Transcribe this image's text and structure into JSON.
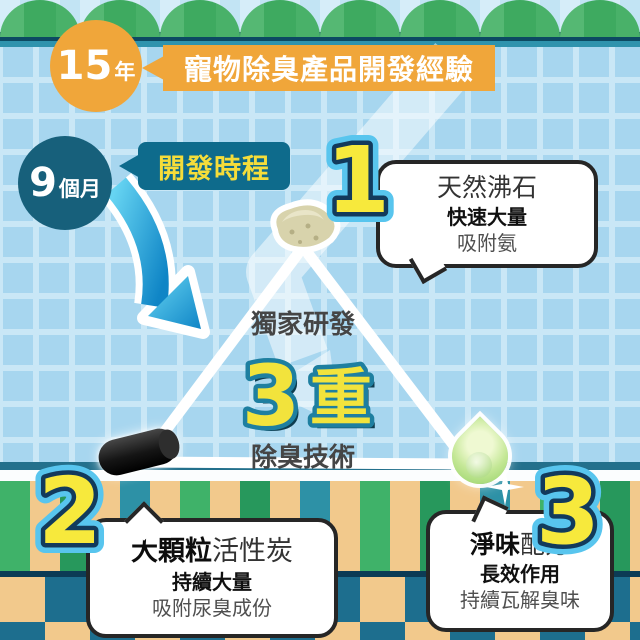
{
  "colors": {
    "background_tile": "#A7D6EF",
    "accent_orange": "#F0A63A",
    "accent_teal_dark": "#0E6B8C",
    "accent_yellow": "#F5E53E",
    "arrow_blue": "#29A8DC",
    "stripe_tan": "#F2C98C",
    "stripe_green": "#3FB269",
    "checker_teal": "#1D6E8E"
  },
  "header": {
    "experience_value": "15",
    "experience_unit": "年",
    "experience_label": "寵物除臭產品開發經驗",
    "timeline_value": "9",
    "timeline_unit": "個月",
    "timeline_label": "開發時程"
  },
  "center": {
    "tagline_top": "獨家研發",
    "big_number": "3",
    "big_unit": "重",
    "tagline_bottom": "除臭技術"
  },
  "points": [
    {
      "number": "1",
      "icon": "zeolite-stone",
      "title_bold": "",
      "title_rest": "天然沸石",
      "line2": "快速大量",
      "line3": "吸附氨"
    },
    {
      "number": "2",
      "icon": "charcoal-pellet",
      "title_bold": "大顆粒",
      "title_rest": "活性炭",
      "line2": "持續大量",
      "line3": "吸附尿臭成份"
    },
    {
      "number": "3",
      "icon": "scent-droplet",
      "title_bold": "淨味",
      "title_rest": "配方",
      "line2": "長效作用",
      "line3": "持續瓦解臭味"
    }
  ]
}
